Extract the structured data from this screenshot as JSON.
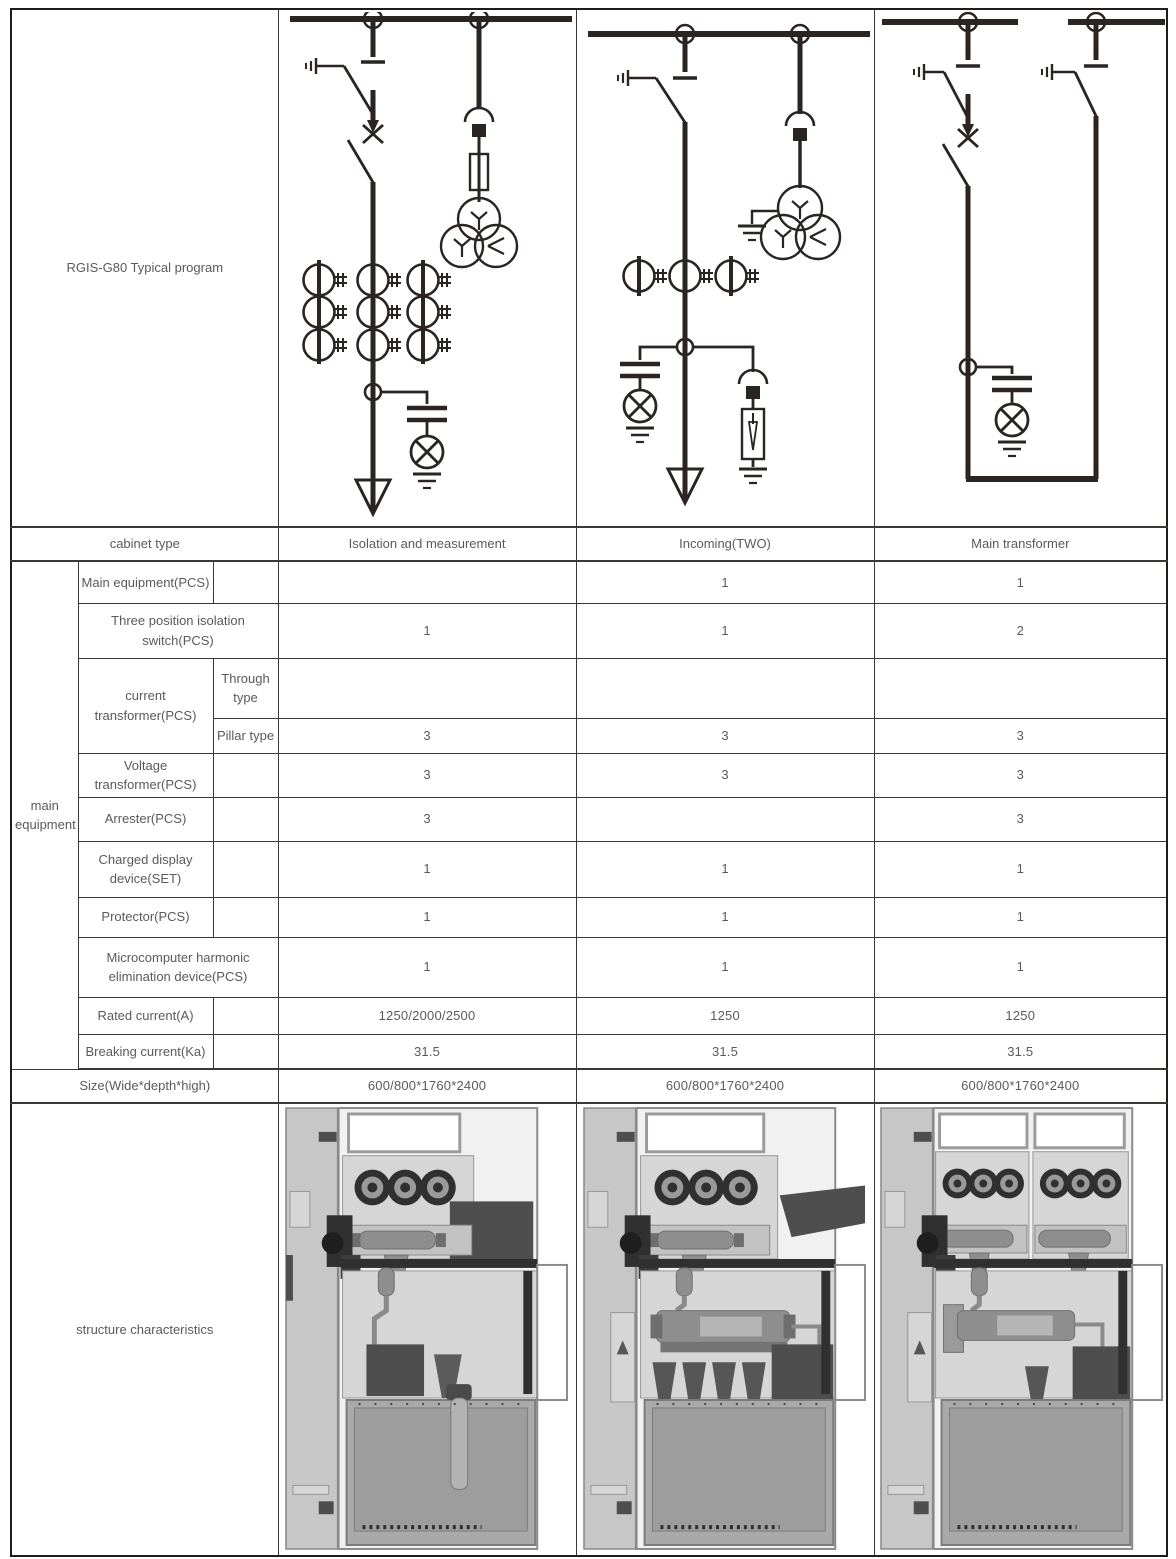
{
  "colors": {
    "grid_line": "#3a3734",
    "text": "#5a5a5a",
    "diagram_stroke": "#2a2423"
  },
  "header": {
    "program_title": "RGIS-G80 Typical program",
    "cabinet_type_label": "cabinet type",
    "cabinet_types": [
      "Isolation and measurement",
      "Incoming(TWO)",
      "Main transformer"
    ]
  },
  "equipment": {
    "group_label": "main equipment",
    "rows": [
      {
        "label": "Main equipment(PCS)",
        "values": [
          "",
          "1",
          "1"
        ]
      },
      {
        "label": "Three position isolation switch(PCS)",
        "values": [
          "1",
          "1",
          "2"
        ]
      },
      {
        "label": "current transformer(PCS)",
        "sub": "Through type",
        "values": [
          "",
          "",
          ""
        ]
      },
      {
        "sub": "Pillar type",
        "values": [
          "3",
          "3",
          "3"
        ]
      },
      {
        "label": "Voltage transformer(PCS)",
        "values": [
          "3",
          "3",
          "3"
        ]
      },
      {
        "label": "Arrester(PCS)",
        "values": [
          "3",
          "",
          "3"
        ]
      },
      {
        "label": "Charged display device(SET)",
        "values": [
          "1",
          "1",
          "1"
        ]
      },
      {
        "label": "Protector(PCS)",
        "values": [
          "1",
          "1",
          "1"
        ]
      },
      {
        "label": "Microcomputer harmonic elimination device(PCS)",
        "values": [
          "1",
          "1",
          "1"
        ]
      },
      {
        "label": "Rated current(A)",
        "values": [
          "1250/2000/2500",
          "1250",
          "1250"
        ]
      },
      {
        "label": "Breaking current(Ka)",
        "values": [
          "31.5",
          "31.5",
          "31.5"
        ]
      }
    ]
  },
  "size": {
    "label": "Size(Wide*depth*high)",
    "values": [
      "600/800*1760*2400",
      "600/800*1760*2400",
      "600/800*1760*2400"
    ]
  },
  "structure": {
    "label": "structure characteristics"
  },
  "figures": {
    "diagrams": [
      "isolation-and-measurement-single-line-diagram",
      "incoming-two-single-line-diagram",
      "main-transformer-single-line-diagram"
    ],
    "photos": [
      "isolation-and-measurement-structure-view",
      "incoming-two-structure-view",
      "main-transformer-structure-view"
    ]
  }
}
